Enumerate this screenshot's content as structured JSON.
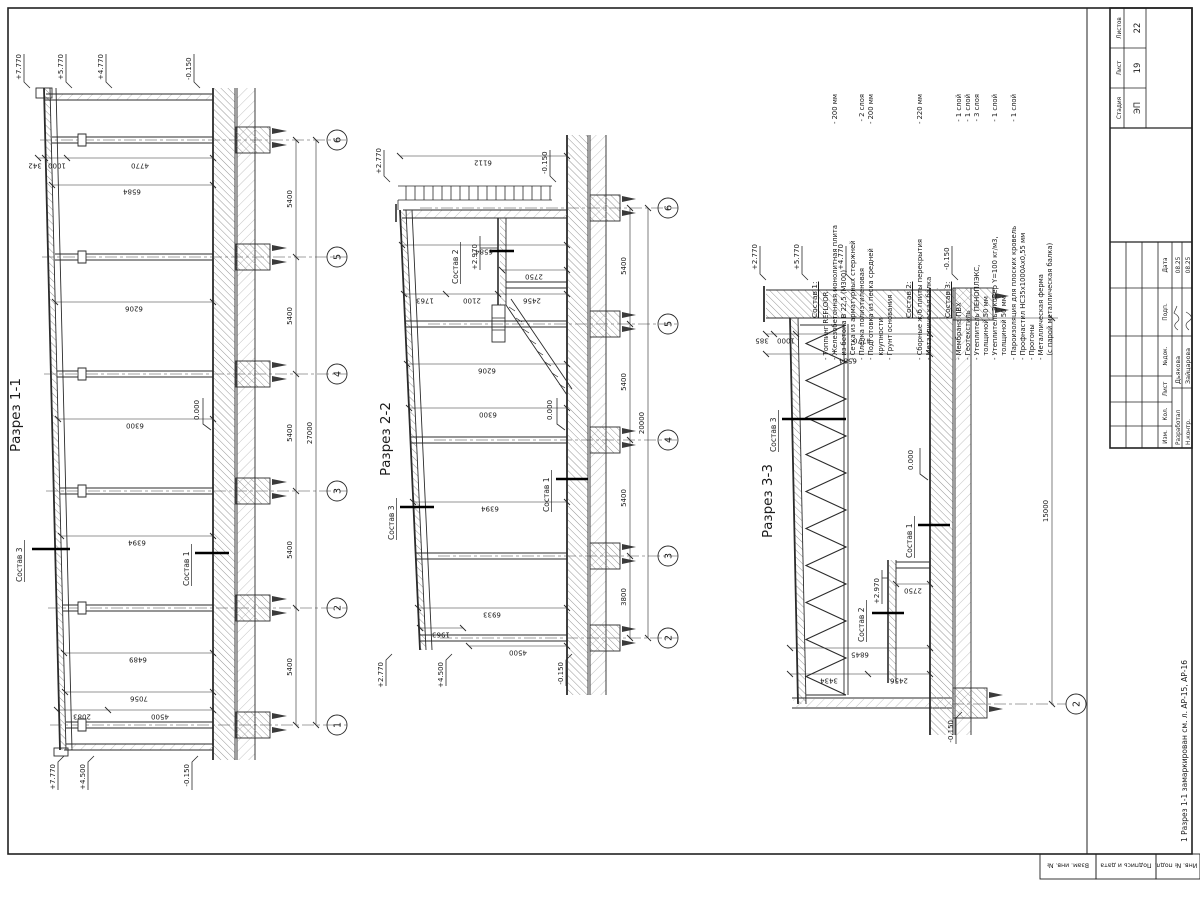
{
  "titleblock": {
    "header_cols": [
      "Изм.",
      "Кол.",
      "Лист",
      "№док.",
      "Подп.",
      "Дата"
    ],
    "sign_rows": [
      {
        "role": "Разработал",
        "name": "Дьякова",
        "date": "08.25"
      },
      {
        "role": "Н.контр.",
        "name": "Зайцарова",
        "date": "08.25"
      }
    ],
    "stage_label": "Стадия",
    "list_label": "Лист",
    "listov_label": "Листов",
    "stage": "ЭП",
    "list_no": "19",
    "listov": "22"
  },
  "side_stamp": {
    "f1": "Взам. инв. №",
    "f2": "Подпись и дата",
    "f3": "Инв. № подл."
  },
  "footnote": "1  Разрез 1-1 замаркирован см. л. АР-15, АР-16",
  "notes": {
    "n1": {
      "title": "Состав 1:",
      "rows": [
        {
          "t": "- Топпинг REFLOOR",
          "v": ""
        },
        {
          "t": "- Железобетонная монолитная плита",
          "v": "- 200 мм"
        },
        {
          "t": "  из бетона В 22,5 (М300)",
          "v": ""
        },
        {
          "t": "- Сетка из арматурных стержней",
          "v": ""
        },
        {
          "t": "- Пленка полиэтиленовая",
          "v": "- 2 слоя"
        },
        {
          "t": "- Подготовка из песка средней",
          "v": "- 200 мм"
        },
        {
          "t": "  крупности",
          "v": ""
        },
        {
          "t": "- Грунт основания",
          "v": ""
        }
      ]
    },
    "n2": {
      "title": "Состав 2:",
      "rows": [
        {
          "t": "- Сборные ж/б плиты перекрытия",
          "v": "- 220 мм"
        },
        {
          "t": "- Металлическая балка",
          "v": ""
        }
      ]
    },
    "n3": {
      "title": "Состав 3:",
      "rows": [
        {
          "t": "- Мембрана ПВХ",
          "v": "- 1 слой"
        },
        {
          "t": "- Геотекстиль",
          "v": "- 1 слой"
        },
        {
          "t": "- Утеплитель ПЕНОПЛЭКС,",
          "v": "- 3 слоя"
        },
        {
          "t": "  толщиной 50 мм",
          "v": ""
        },
        {
          "t": "- Утеплитель ЭкоВер Y=100 кг/м3,",
          "v": "- 1 слой"
        },
        {
          "t": "  толщиной 50 мм",
          "v": ""
        },
        {
          "t": "- Пароизоляция для плоских кровель",
          "v": "- 1 слой"
        },
        {
          "t": "- Профнастил НС35х1000Ах0,55 мм",
          "v": ""
        },
        {
          "t": "- Прогоны",
          "v": ""
        },
        {
          "t": "- Металлическая ферма",
          "v": ""
        },
        {
          "t": "  (с парой металлическая балка)",
          "v": ""
        }
      ]
    }
  },
  "s1": {
    "title": "Разрез 1-1",
    "bubbles": [
      "1",
      "2",
      "3",
      "4",
      "5",
      "6"
    ],
    "spans": [
      "5400",
      "5400",
      "5400",
      "5400",
      "5400"
    ],
    "total": "27000",
    "heights": [
      "7056",
      "6489",
      "6394",
      "6300",
      "6206",
      "6584"
    ],
    "chain_left": [
      "2083",
      "4500"
    ],
    "chain_right": [
      "342",
      "1000",
      "4770"
    ],
    "elev_right": [
      "+7.770",
      "+5.770",
      "+4.770"
    ],
    "elev_left": [
      "+7.770",
      "+4.500"
    ],
    "elev_zero": "0.000",
    "elev_m015_l": "-0.150",
    "elev_m015_r": "-0.150",
    "lbl_c1": "Состав 1",
    "lbl_c3": "Состав 3"
  },
  "s2": {
    "title": "Разрез 2-2",
    "bubbles": [
      "2",
      "3",
      "4",
      "5",
      "6"
    ],
    "spans": [
      "3800",
      "5400",
      "5400",
      "5400"
    ],
    "total": "20000",
    "heights": [
      "6933",
      "6394",
      "6300",
      "6206",
      "6584",
      "6112"
    ],
    "mezz_chain": [
      "1763",
      "2100",
      "2456"
    ],
    "d2750": "2750",
    "d4500": "4500",
    "d1963": "1963",
    "elev_right": "+2.770",
    "elev_left": "+2.770",
    "elev_450": "+4.500",
    "elev_zero": "0.000",
    "elev_m015_l": "-0.150",
    "elev_m015_r": "-0.150",
    "elev_mezz": "+2.970",
    "lbl_c1": "Состав 1",
    "lbl_c2": "Состав 2",
    "lbl_c3": "Состав 3"
  },
  "s3": {
    "title": "Разрез 3-3",
    "bubble": "2",
    "total": "15000",
    "chain_right": [
      "385",
      "1000",
      "4770"
    ],
    "h6584": "6584",
    "chain_left": [
      "3434",
      "2456"
    ],
    "h6845": "6845",
    "d2750": "2750",
    "elev": [
      "+2.770",
      "+5.770",
      "+4.770"
    ],
    "elev_m015_r": "-0.150",
    "elev_m015_l": "-0.150",
    "elev_zero": "0.000",
    "elev_mezz": "+2.970",
    "lbl_c1": "Состав 1",
    "lbl_c2": "Состав 2",
    "lbl_c3": "Состав 3"
  }
}
